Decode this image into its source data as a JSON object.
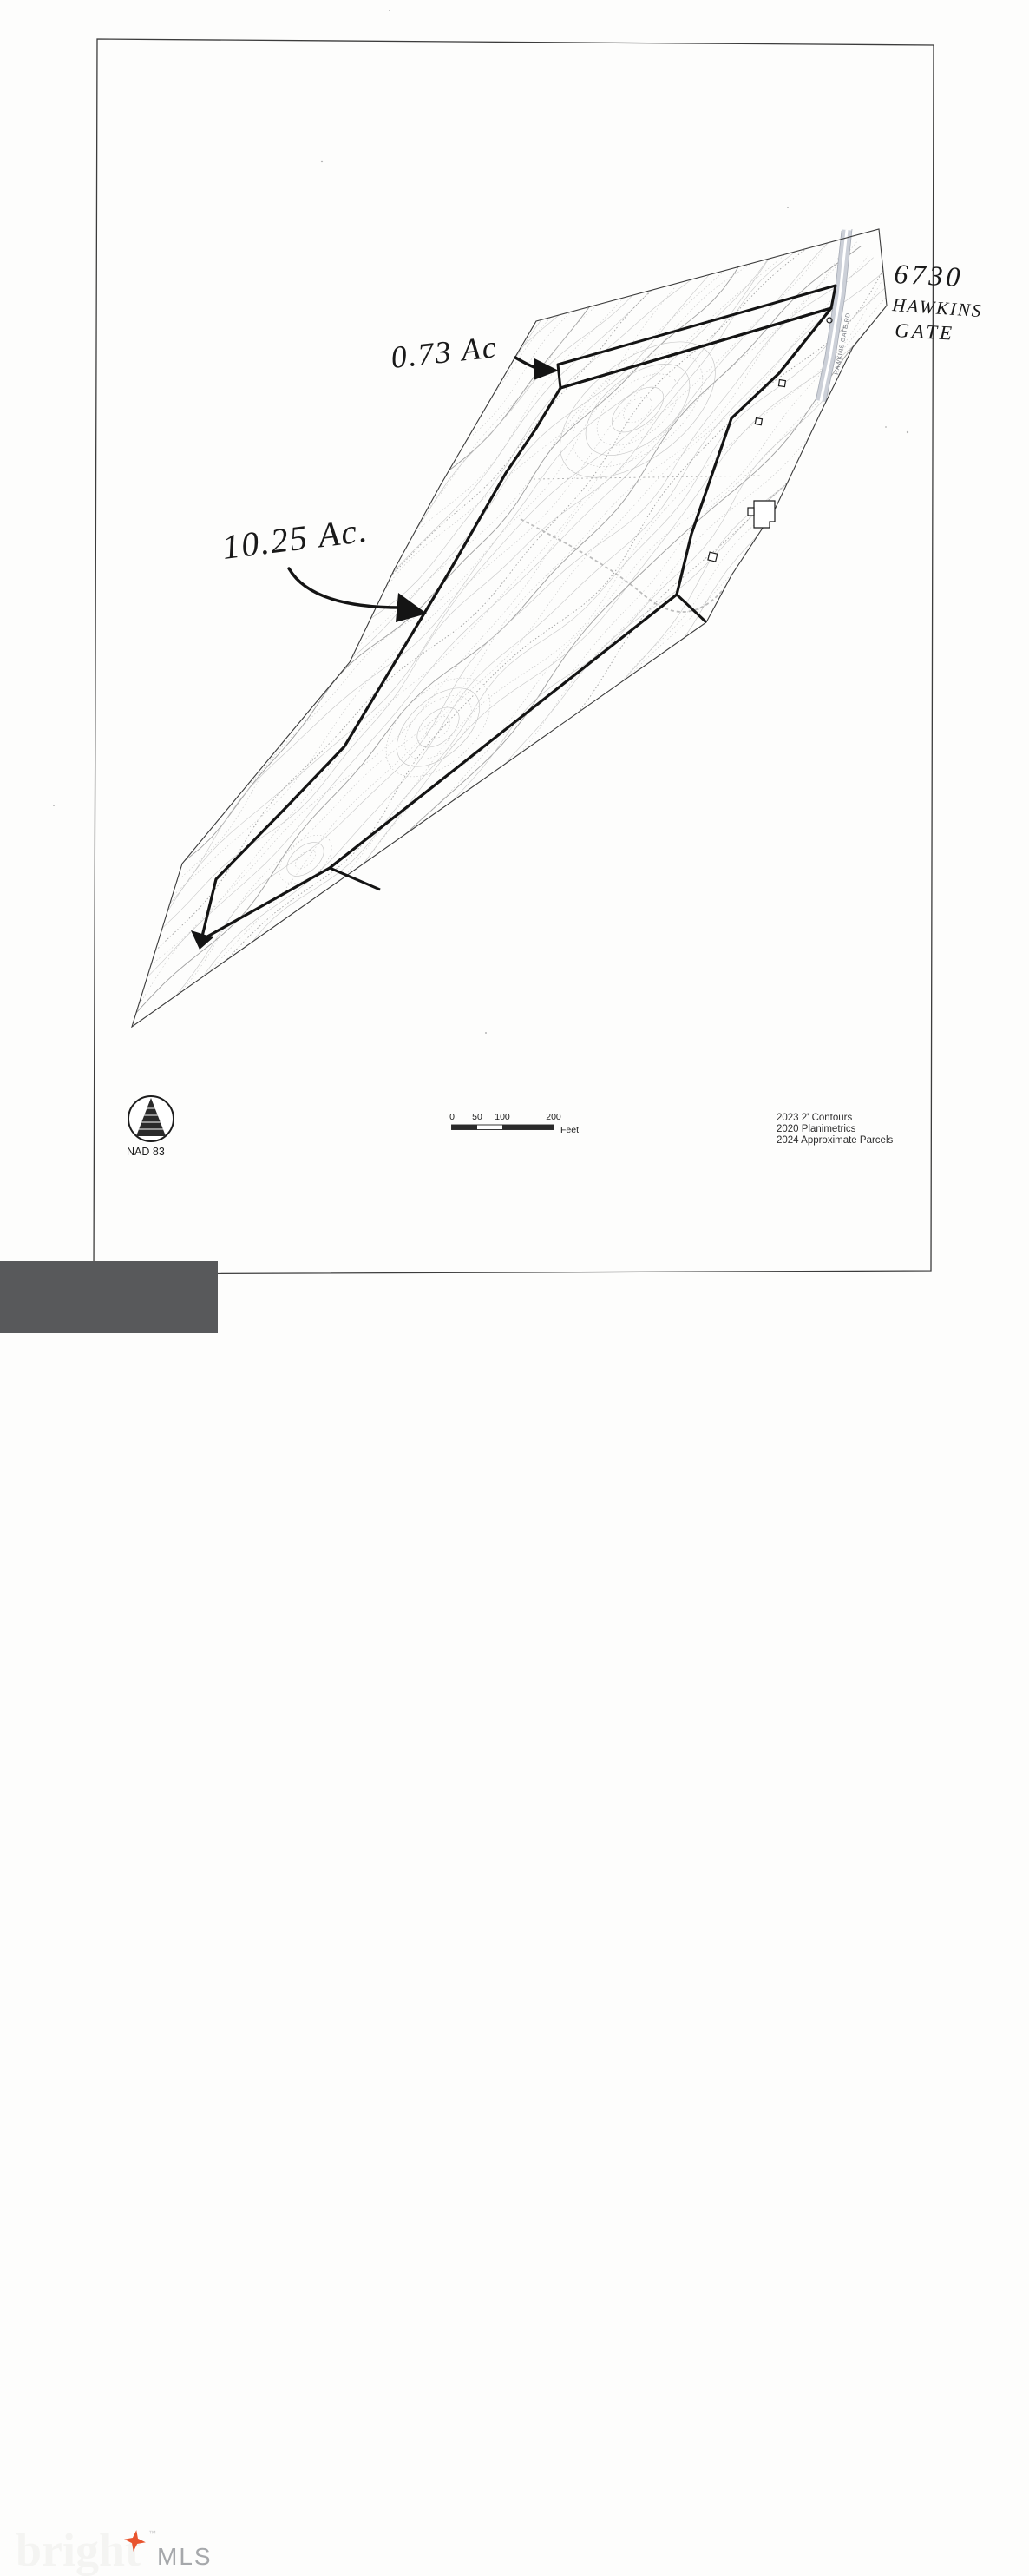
{
  "map": {
    "handwritten": {
      "small_parcel_acreage": "0.73 Ac",
      "large_parcel_acreage": "10.25 Ac.",
      "address_line1": "6730",
      "address_line2": "HAWKINS",
      "address_line3": "GATE"
    },
    "road_label": "HAWKINS GATE RD",
    "datum": "NAD 83"
  },
  "scale_bar": {
    "tick0": "0",
    "tick50": "50",
    "tick100": "100",
    "tick200": "200",
    "unit": "Feet"
  },
  "legend": {
    "line1": "2023 2' Contours",
    "line2": "2020 Planimetrics",
    "line3": "2024 Approximate Parcels"
  },
  "branding": {
    "wordmark": "bright",
    "trademark": "™",
    "suffix": "MLS"
  },
  "colors": {
    "accent_star": "#e8542e",
    "logo_bar": "#58595b",
    "road_fill": "#ccd0d8",
    "boundary_bold": "#141414",
    "contour_light": "#c7c7c7"
  }
}
